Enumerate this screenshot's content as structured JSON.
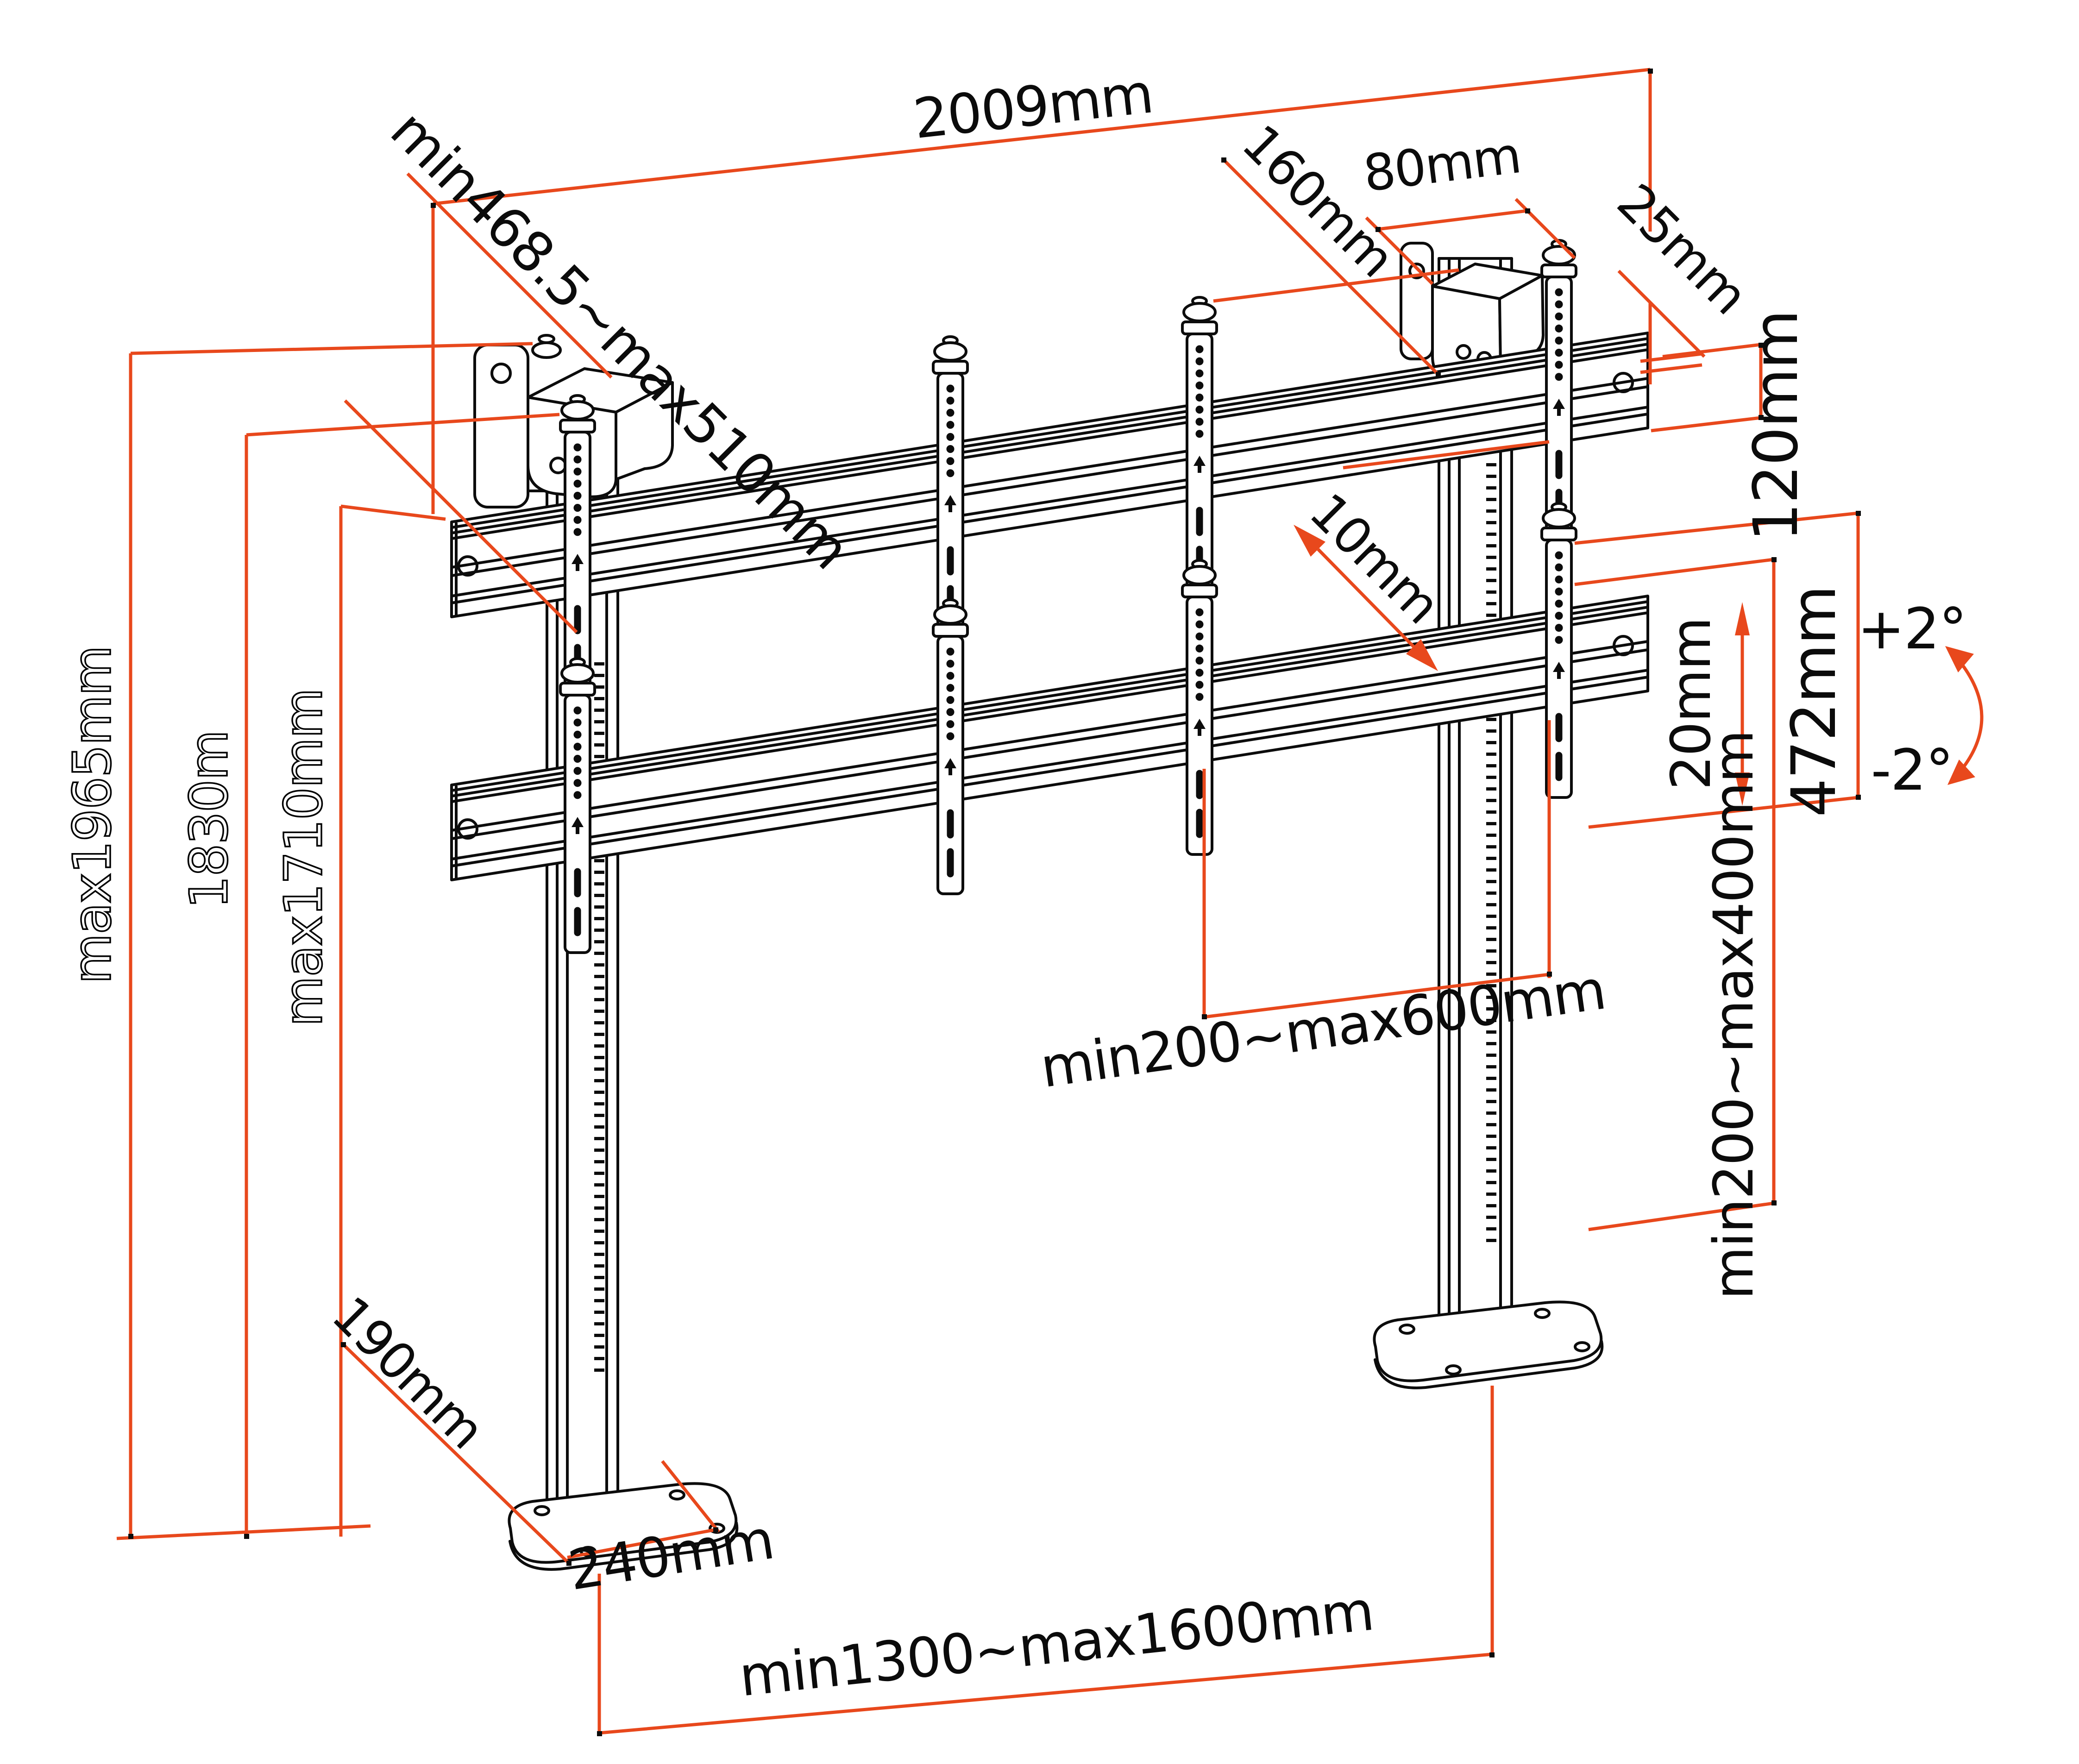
{
  "diagram": {
    "kind": "technical-dimension-drawing",
    "subject": "dual-column video wall floor stand, isometric view with dimension callouts",
    "colors": {
      "dimension_lines": "#e8481c",
      "drawing_lines": "#0c0c0c",
      "background": "#ffffff",
      "outline_text_fill": "#ffffff"
    },
    "labels": {
      "top_width": "2009mm",
      "bracket_depth_range": "min468.5~max510mm",
      "shelf_depth": "160mm",
      "shelf_width": "80mm",
      "rail_offset": "25mm",
      "rail_height": "120mm",
      "height_max": "max1965mm",
      "height_mid": "1830m",
      "height_rail": "max1710mm",
      "depth_adjust": "10mm",
      "height_adjust": "20mm",
      "bracket_height": "472mm",
      "tilt_up": "+2°",
      "tilt_down": "-2°",
      "vesa_width_range": "min200~max600mm",
      "vesa_height_range": "min200~max400mm",
      "base_front_offset": "190mm",
      "base_depth": "240mm",
      "column_spacing_range": "min1300~max1600mm"
    }
  }
}
